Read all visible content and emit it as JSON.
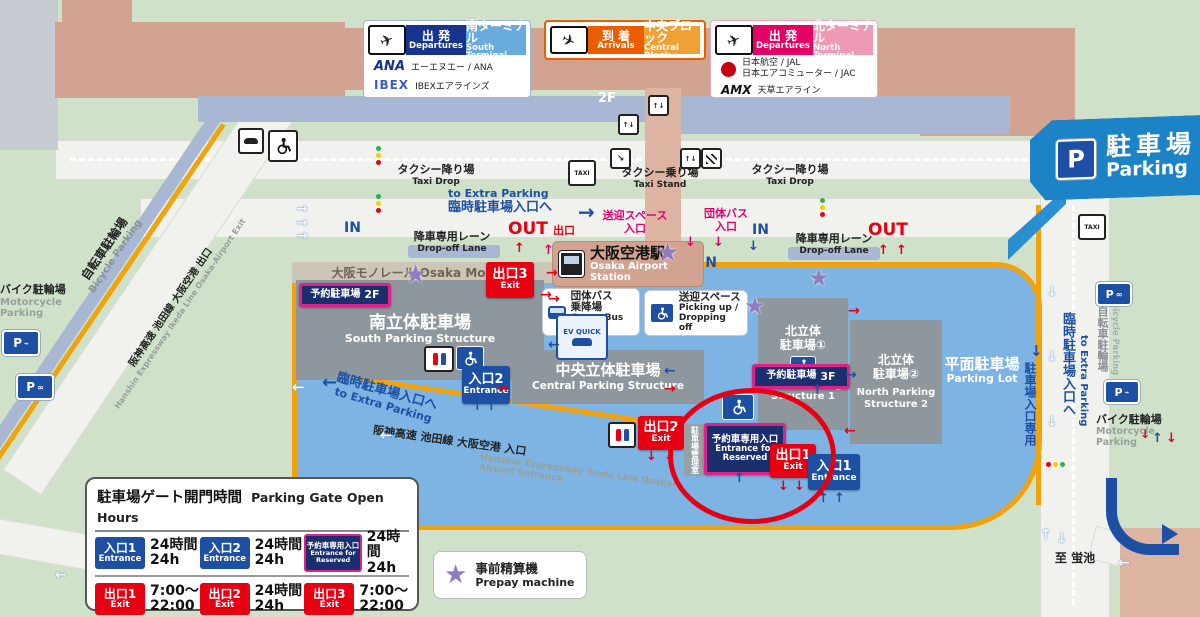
{
  "headers": {
    "south": {
      "dep_jp": "出 発",
      "dep_en": "Departures",
      "term_jp": "南ターミナル",
      "term_en": "South Terminal",
      "airlines": [
        {
          "logo": "ANA",
          "name": "エーエヌエー / ANA"
        },
        {
          "logo": "IBEX",
          "name": "IBEXエアラインズ"
        }
      ]
    },
    "central": {
      "dep_jp": "到 着",
      "dep_en": "Arrivals",
      "term_jp": "中央ブロック",
      "term_en": "Central Block"
    },
    "north": {
      "dep_jp": "出 発",
      "dep_en": "Departures",
      "term_jp": "北ターミナル",
      "term_en": "North Terminal",
      "airlines": [
        {
          "logo": "JAL",
          "name": "日本航空 / JAL",
          "name2": "日本エアコミューター / JAC"
        },
        {
          "logo": "AMX",
          "name": "天草エアライン"
        }
      ]
    }
  },
  "parking_banner": {
    "p": "P",
    "jp": "駐車場",
    "en": "Parking"
  },
  "floor_label": "2F",
  "monorail_label": "大阪モノレール Osaka Monorail",
  "station": {
    "jp": "大阪空港駅",
    "en": "Osaka Airport Station"
  },
  "group_bus": {
    "jp1": "団体バス",
    "jp2": "乗降場",
    "en": "Group Bus Stop"
  },
  "pickup": {
    "jp": "送迎スペース",
    "en1": "Picking up /",
    "en2": "Dropping off"
  },
  "structures": {
    "south": {
      "jp": "南立体駐車場",
      "en": "South Parking Structure",
      "badge": "予約駐車場",
      "badge_floor": "2F"
    },
    "central": {
      "jp": "中央立体駐車場",
      "en": "Central Parking Structure"
    },
    "north1": {
      "jp1": "北立体",
      "jp2": "駐車場①",
      "en1": "North Parking",
      "en2": "Structure 1",
      "badge": "予約駐車場",
      "badge_floor": "3F"
    },
    "north2": {
      "jp1": "北立体",
      "jp2": "駐車場②",
      "en1": "North Parking",
      "en2": "Structure 2"
    },
    "lot": {
      "jp": "平面駐車場",
      "en": "Parking Lot"
    }
  },
  "gates": {
    "entrance1": {
      "jp": "入口1",
      "en": "Entrance"
    },
    "entrance2": {
      "jp": "入口2",
      "en": "Entrance"
    },
    "exit1": {
      "jp": "出口1",
      "en": "Exit"
    },
    "exit2": {
      "jp": "出口2",
      "en": "Exit"
    },
    "exit3": {
      "jp": "出口3",
      "en": "Exit"
    },
    "reserved": {
      "jp": "予約車専用入口",
      "en1": "Entrance for",
      "en2": "Reserved"
    }
  },
  "labels": {
    "taxi_drop_jp": "タクシー降り場",
    "taxi_drop_en": "Taxi Drop",
    "taxi_stand_jp": "タクシー乗り場",
    "taxi_stand_en": "Taxi Stand",
    "extra_parking_en": "to Extra Parking",
    "extra_parking_jp": "臨時駐車場入口へ",
    "in": "IN",
    "out": "OUT",
    "out_exit_jp": "出口",
    "dropoff_jp": "降車専用レーン",
    "dropoff_en": "Drop-off Lane",
    "pickup_entrance_jp1": "送迎スペース",
    "pickup_entrance_jp2": "入口",
    "groupbus_entrance_jp1": "団体バス",
    "groupbus_entrance_jp2": "入口",
    "mgmt_office": "駐車場管理室",
    "parking_entrance_only": "駐車場入口専用",
    "bicycle_jp": "自転車駐輪場",
    "bicycle_en": "Bicycle Parking",
    "motorcycle_jp": "バイク駐輪場",
    "motorcycle_en1": "Motorcycle",
    "motorcycle_en2": "Parking",
    "hanshin_exit_jp": "阪神高速 池田線 大阪空港 出口",
    "hanshin_exit_en": "Hanshin Expressway Ikeda Line Osaka-Airport Exit",
    "hanshin_entrance_jp": "阪神高速 池田線 大阪空港 入口",
    "hanshin_entrance_en": "Hanshin Expressway Ikeda Line Osaka-Airport Entrance",
    "to_hotarugaike": "至 蛍池",
    "ev_quick": "EV QUICK",
    "taxi": "TAXI"
  },
  "gate_hours": {
    "title_jp": "駐車場ゲート開門時間",
    "title_en": "Parking Gate Open Hours",
    "cells": [
      {
        "badge_jp": "入口1",
        "badge_en": "Entrance",
        "h1": "24時間",
        "h2": "24h"
      },
      {
        "badge_jp": "入口2",
        "badge_en": "Entrance",
        "h1": "24時間",
        "h2": "24h"
      },
      {
        "badge_jp": "予約車専用入口",
        "badge_en1": "Entrance for",
        "badge_en2": "Reserved",
        "h1": "24時間",
        "h2": "24h"
      },
      {
        "badge_jp": "出口1",
        "badge_en": "Exit",
        "h1": "7:00～",
        "h2": "22:00"
      },
      {
        "badge_jp": "出口2",
        "badge_en": "Exit",
        "h1": "24時間",
        "h2": "24h"
      },
      {
        "badge_jp": "出口3",
        "badge_en": "Exit",
        "h1": "7:00～",
        "h2": "22:00"
      }
    ]
  },
  "prepay": {
    "jp": "事前精算機",
    "en": "Prepay machine"
  },
  "icons": {
    "star": "★",
    "up": "↑",
    "down": "↓",
    "left": "←",
    "right": "→",
    "updown": "↑↓",
    "diag": "↘"
  },
  "colors": {
    "entrance_blue": "#1d50a2",
    "exit_red": "#e60012",
    "reserved_navy": "#1b2f6e",
    "reserved_border": "#e0218a",
    "parking_blue": "#7db4e4",
    "route_orange": "#f2a20d",
    "prepay_purple": "#8f7dc0"
  }
}
